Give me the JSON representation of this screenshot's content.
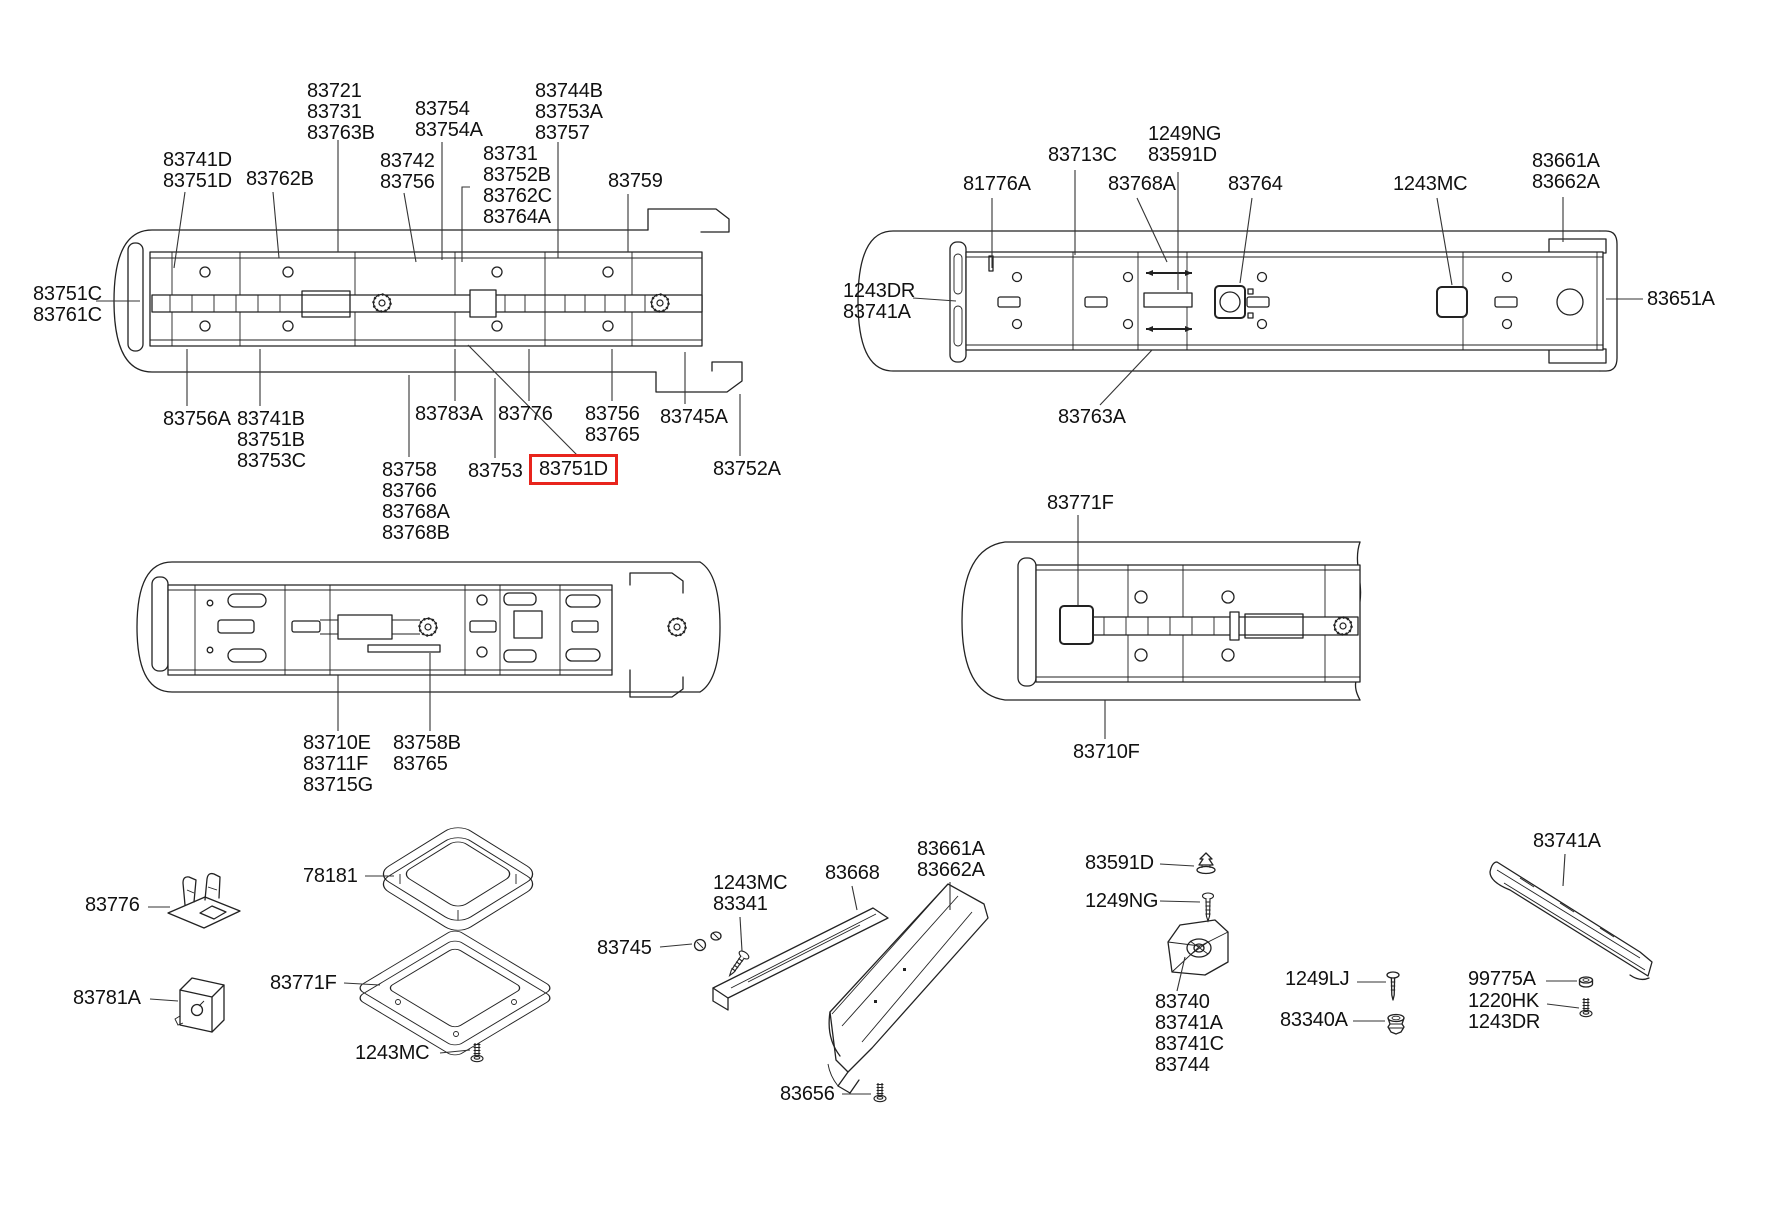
{
  "figure": {
    "type": "parts-catalog-exploded-diagram",
    "background": "#ffffff",
    "line_color": "#222222",
    "highlight_color": "#e8241c",
    "highlighted_part": "83751D"
  },
  "labels": {
    "d1_83741D": "83741D\n83751D",
    "d1_83762B": "83762B",
    "d1_83721": "83721\n83731\n83763B",
    "d1_83742": "83742\n83756",
    "d1_83754": "83754\n83754A",
    "d1_83731stack": "83731\n83752B\n83762C\n83764A",
    "d1_83744B": "83744B\n83753A\n83757",
    "d1_83759": "83759",
    "d1_83751C": "83751C\n83761C",
    "d1_83756A": "83756A",
    "d1_83741B": "83741B\n83751B\n83753C",
    "d1_83758": "83758\n83766\n83768A\n83768B",
    "d1_83783A": "83783A",
    "d1_83753": "83753",
    "d1_83751D": "83751D",
    "d1_83776": "83776",
    "d1_83756b": "83756\n83765",
    "d1_83745A": "83745A",
    "d1_83752A": "83752A",
    "d2_81776A": "81776A",
    "d2_83713C": "83713C",
    "d2_1249NG": "1249NG\n83591D",
    "d2_83768A": "83768A",
    "d2_83764": "83764",
    "d2_1243MC": "1243MC",
    "d2_83661A": "83661A\n83662A",
    "d2_1243DR": "1243DR\n83741A",
    "d2_83651A": "83651A",
    "d2_83763A": "83763A",
    "d3_83710E": "83710E\n83711F\n83715G",
    "d3_83758B": "83758B\n83765",
    "d4_83771F": "83771F",
    "d4_83710F": "83710F",
    "p_83776": "83776",
    "p_78181": "78181",
    "p_83781A": "83781A",
    "p_83771F": "83771F",
    "p_1243MC_left": "1243MC",
    "p_83745": "83745",
    "p_1243MC_mid": "1243MC\n83341",
    "p_83668": "83668",
    "p_83661A": "83661A\n83662A",
    "p_83656": "83656",
    "p_83591D": "83591D",
    "p_1249NG": "1249NG",
    "p_83740": "83740\n83741A\n83741C\n83744",
    "p_1249LJ": "1249LJ",
    "p_83340A": "83340A",
    "p_83741A": "83741A",
    "p_99775A": "99775A",
    "p_1220HK": "1220HK\n1243DR"
  }
}
